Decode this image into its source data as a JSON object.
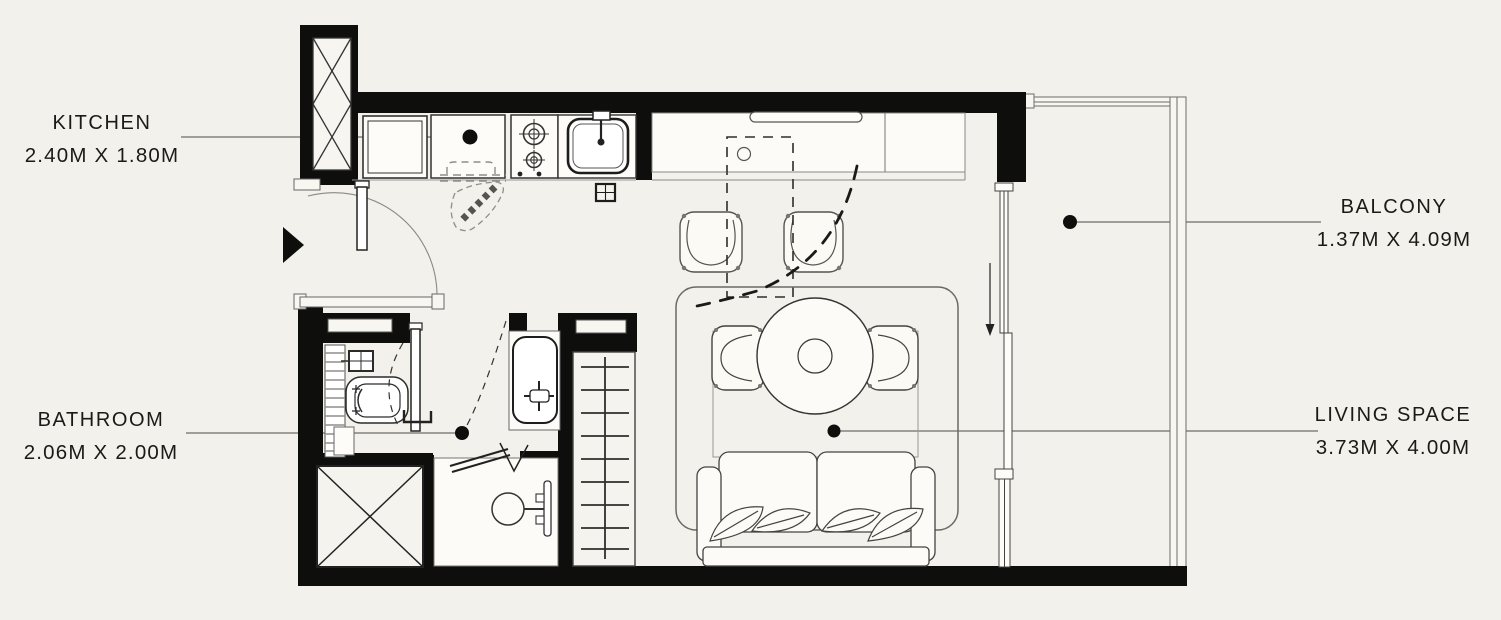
{
  "colors": {
    "background": "#f2f1eb",
    "walls": "#0e0e0c",
    "fixture_lines": "#3a3a38",
    "label_text": "#1b1a17"
  },
  "rooms": [
    {
      "id": "kitchen",
      "label": "KITCHEN",
      "dimensions": "2.40M X 1.80M"
    },
    {
      "id": "bathroom",
      "label": "BATHROOM",
      "dimensions": "2.06M X 2.00M"
    },
    {
      "id": "balcony",
      "label": "BALCONY",
      "dimensions": "1.37M X 4.09M"
    },
    {
      "id": "living_space",
      "label": "LIVING SPACE",
      "dimensions": "3.73M X 4.00M"
    }
  ]
}
